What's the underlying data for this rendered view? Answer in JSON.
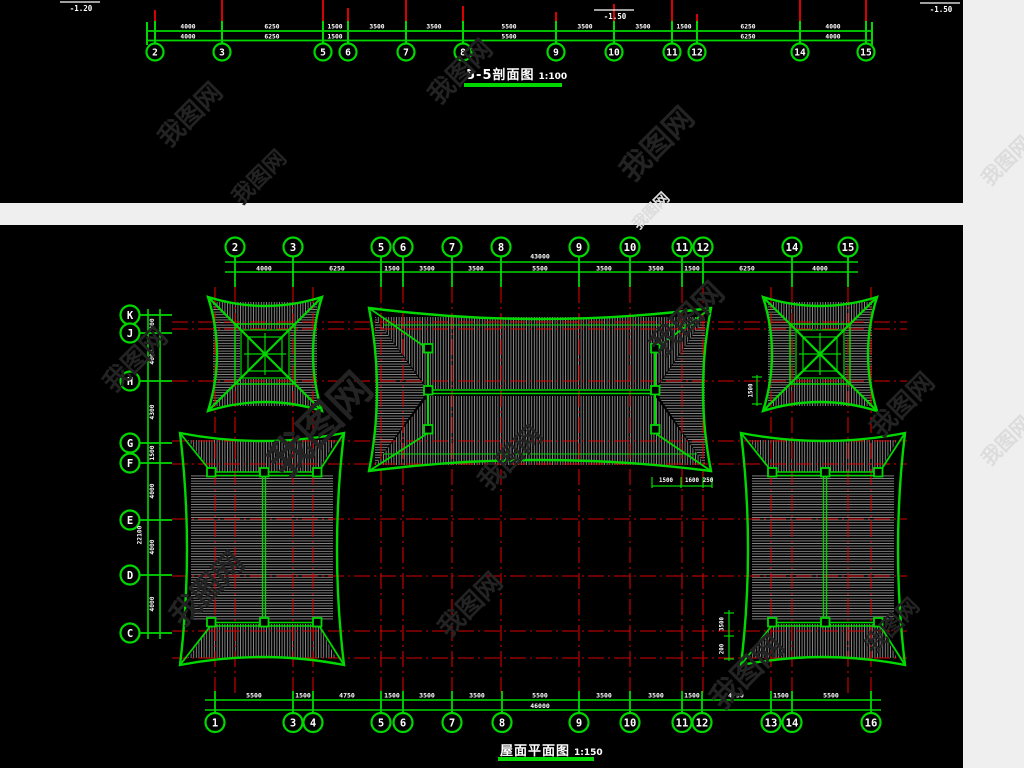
{
  "page": {
    "background": "#efefef",
    "panel_background": "#000000"
  },
  "colors": {
    "green": "#00d800",
    "red": "#d80000",
    "white": "#ffffff",
    "hatch": "#8c8c8c",
    "wm_dark": "#232323",
    "wm_light": "#dcdcdc"
  },
  "watermark": {
    "text": "我图网"
  },
  "section": {
    "title": "5-5剖面图",
    "scale": "1:100",
    "elevations": [
      {
        "text": "-1.20",
        "x": 60,
        "y": 2
      },
      {
        "text": "-1.50",
        "x": 594,
        "y": 10
      },
      {
        "text": "-1.50",
        "x": 920,
        "y": 3
      }
    ],
    "grids": [
      {
        "label": "2",
        "x": 155,
        "red_top": 10
      },
      {
        "label": "3",
        "x": 222,
        "red_top": 0
      },
      {
        "label": "5",
        "x": 323,
        "red_top": 0
      },
      {
        "label": "6",
        "x": 348,
        "red_top": 8
      },
      {
        "label": "7",
        "x": 406,
        "red_top": 0
      },
      {
        "label": "8",
        "x": 463,
        "red_top": 6
      },
      {
        "label": "9",
        "x": 556,
        "red_top": 12
      },
      {
        "label": "10",
        "x": 614,
        "red_top": 4
      },
      {
        "label": "11",
        "x": 672,
        "red_top": 0
      },
      {
        "label": "12",
        "x": 697,
        "red_top": 14
      },
      {
        "label": "14",
        "x": 800,
        "red_top": 0
      },
      {
        "label": "15",
        "x": 866,
        "red_top": 0
      }
    ],
    "dims_row1": [
      {
        "v": "4000",
        "x": 188
      },
      {
        "v": "6250",
        "x": 272
      },
      {
        "v": "1500",
        "x": 335
      },
      {
        "v": "3500",
        "x": 377
      },
      {
        "v": "3500",
        "x": 434
      },
      {
        "v": "5500",
        "x": 509
      },
      {
        "v": "3500",
        "x": 585
      },
      {
        "v": "3500",
        "x": 643
      },
      {
        "v": "1500",
        "x": 684
      },
      {
        "v": "6250",
        "x": 748
      },
      {
        "v": "4000",
        "x": 833
      }
    ],
    "dims_row2": [
      {
        "v": "4000",
        "x": 188
      },
      {
        "v": "6250",
        "x": 272
      },
      {
        "v": "1500",
        "x": 335
      },
      {
        "v": "5500",
        "x": 509
      },
      {
        "v": "6250",
        "x": 748
      },
      {
        "v": "4000",
        "x": 833
      }
    ]
  },
  "plan": {
    "title": "屋面平面图",
    "scale": "1:150",
    "top_axis": {
      "total": "43000",
      "grids": [
        {
          "label": "2",
          "x": 235
        },
        {
          "label": "3",
          "x": 293
        },
        {
          "label": "5",
          "x": 381
        },
        {
          "label": "6",
          "x": 403
        },
        {
          "label": "7",
          "x": 452
        },
        {
          "label": "8",
          "x": 501
        },
        {
          "label": "9",
          "x": 579
        },
        {
          "label": "10",
          "x": 630
        },
        {
          "label": "11",
          "x": 682
        },
        {
          "label": "12",
          "x": 703
        },
        {
          "label": "14",
          "x": 792
        },
        {
          "label": "15",
          "x": 848
        }
      ],
      "dims": [
        {
          "v": "4000",
          "x": 264
        },
        {
          "v": "6250",
          "x": 337
        },
        {
          "v": "1500",
          "x": 392
        },
        {
          "v": "3500",
          "x": 427
        },
        {
          "v": "3500",
          "x": 476
        },
        {
          "v": "5500",
          "x": 540
        },
        {
          "v": "3500",
          "x": 604
        },
        {
          "v": "3500",
          "x": 656
        },
        {
          "v": "1500",
          "x": 692
        },
        {
          "v": "6250",
          "x": 747
        },
        {
          "v": "4000",
          "x": 820
        }
      ]
    },
    "bottom_axis": {
      "total": "46000",
      "grids": [
        {
          "label": "1",
          "x": 215
        },
        {
          "label": "3",
          "x": 293
        },
        {
          "label": "4",
          "x": 313
        },
        {
          "label": "5",
          "x": 381
        },
        {
          "label": "6",
          "x": 403
        },
        {
          "label": "7",
          "x": 452
        },
        {
          "label": "8",
          "x": 502
        },
        {
          "label": "9",
          "x": 579
        },
        {
          "label": "10",
          "x": 630
        },
        {
          "label": "11",
          "x": 682
        },
        {
          "label": "12",
          "x": 702
        },
        {
          "label": "13",
          "x": 771
        },
        {
          "label": "14",
          "x": 792
        },
        {
          "label": "16",
          "x": 871
        }
      ],
      "dims": [
        {
          "v": "5500",
          "x": 254
        },
        {
          "v": "1500",
          "x": 303
        },
        {
          "v": "4750",
          "x": 347
        },
        {
          "v": "1500",
          "x": 392
        },
        {
          "v": "3500",
          "x": 427
        },
        {
          "v": "3500",
          "x": 477
        },
        {
          "v": "5500",
          "x": 540
        },
        {
          "v": "3500",
          "x": 604
        },
        {
          "v": "3500",
          "x": 656
        },
        {
          "v": "1500",
          "x": 692
        },
        {
          "v": "4750",
          "x": 736
        },
        {
          "v": "1500",
          "x": 781
        },
        {
          "v": "5500",
          "x": 831
        }
      ]
    },
    "left_axis": {
      "total": "22100",
      "grids": [
        {
          "label": "K",
          "y": 90
        },
        {
          "label": "J",
          "y": 108
        },
        {
          "label": "H",
          "y": 156
        },
        {
          "label": "G",
          "y": 218
        },
        {
          "label": "F",
          "y": 238
        },
        {
          "label": "E",
          "y": 295
        },
        {
          "label": "D",
          "y": 350
        },
        {
          "label": "C",
          "y": 408
        }
      ],
      "dims": [
        {
          "v": "300",
          "y": 99
        },
        {
          "v": "4000",
          "y": 132
        },
        {
          "v": "4300",
          "y": 187
        },
        {
          "v": "1500",
          "y": 228
        },
        {
          "v": "4000",
          "y": 266
        },
        {
          "v": "4000",
          "y": 322
        },
        {
          "v": "4000",
          "y": 379
        }
      ]
    },
    "detail_dims": {
      "center": [
        "1500",
        "1600",
        "250"
      ],
      "pavilion": "1500",
      "hall": [
        "3500",
        "200"
      ]
    }
  }
}
